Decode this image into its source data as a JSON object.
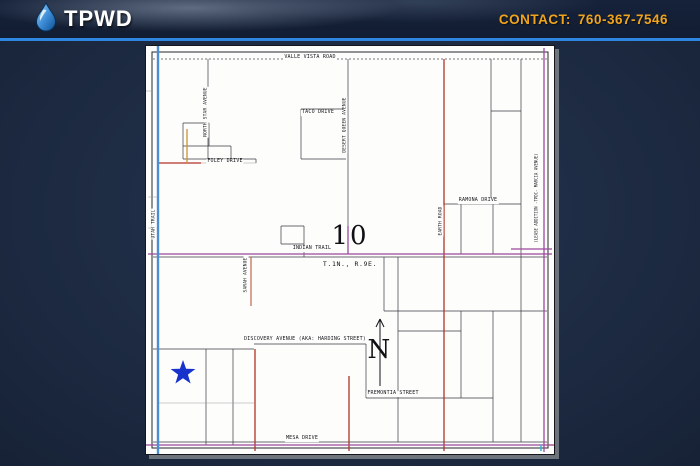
{
  "header": {
    "logo_text": "TPWD",
    "contact_label": "CONTACT:",
    "contact_phone": "760-367-7546",
    "accent_color": "#f0a41c",
    "divider_color": "#2e86e0"
  },
  "map": {
    "section_number": "10",
    "township_range": "T.1N., R.9E.",
    "compass_label": "N",
    "marker": "blue-star",
    "labels": {
      "valle_vista_road": "VALLE VISTA ROAD",
      "taco_drive": "TACO DRIVE",
      "north_star_avenue": "NORTH STAR AVENUE",
      "foley_drive": "FOLEY DRIVE",
      "utah_trail": "UTAH TRAIL",
      "desert_queen_avenue": "DESERT QUEEN AVENUE",
      "indian_trail": "INDIAN TRAIL",
      "sarah_avenue": "SARAH AVENUE",
      "ramona_drive": "RAMONA DRIVE",
      "earth_road": "EARTH ROAD",
      "lease_addition": "(LEASE ADDITION -TPDC- MARCIA AVENUE)",
      "discovery_avenue": "DISCOVERY AVENUE (AKA: HARDING STREET)",
      "fremontia_street": "FREMONTIA STREET",
      "mesa_drive": "MESA DRIVE"
    },
    "colors": {
      "star_blue": "#1733cc",
      "road_blue": "#4a8fd4",
      "road_red": "#b23326",
      "road_orange": "#cf8f35",
      "road_purple": "#9b4a9b",
      "road_cyan": "#2ab5d8"
    }
  }
}
